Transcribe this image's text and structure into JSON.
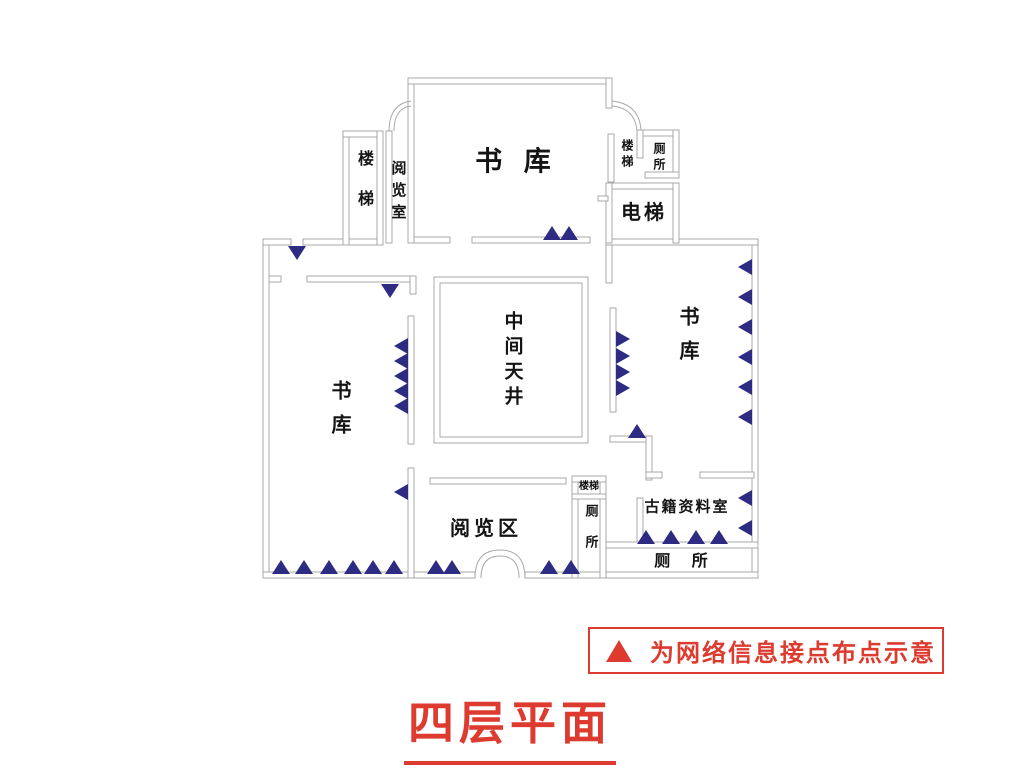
{
  "title": {
    "text": "四层平面"
  },
  "legend": {
    "symbol": "triangle-up",
    "text": "为网络信息接点布点示意"
  },
  "colors": {
    "wall": "#a9a9a9",
    "marker": "#2e2c82",
    "accent_red": "#dd3b2f",
    "label_text": "#141414"
  },
  "labels": {
    "stairs_tl": "楼梯",
    "reading_room_tl": "阅览室",
    "stacks_top": "书 库",
    "stairs_tr": "楼梯",
    "toilet_tr": "厕所",
    "elevator": "电梯",
    "atrium": "中间天井",
    "stacks_right": "书库",
    "stacks_left": "书库",
    "reading_area": "阅览区",
    "stairs_mid": "楼梯",
    "toilet_mid": "厕所",
    "archives": "古籍资料室",
    "toilet_br": "厕 所"
  },
  "markers": {
    "meaning": "网络信息接点布点",
    "color": "#2e2c82",
    "points": [
      {
        "dir": "up",
        "x": 552,
        "y": 240
      },
      {
        "dir": "up",
        "x": 569,
        "y": 240
      },
      {
        "dir": "down",
        "x": 297,
        "y": 246
      },
      {
        "dir": "down",
        "x": 390,
        "y": 284
      },
      {
        "dir": "left",
        "x": 408,
        "y": 346
      },
      {
        "dir": "left",
        "x": 408,
        "y": 361
      },
      {
        "dir": "left",
        "x": 408,
        "y": 376
      },
      {
        "dir": "left",
        "x": 408,
        "y": 391
      },
      {
        "dir": "left",
        "x": 408,
        "y": 406
      },
      {
        "dir": "left",
        "x": 408,
        "y": 492
      },
      {
        "dir": "right",
        "x": 616,
        "y": 339
      },
      {
        "dir": "right",
        "x": 616,
        "y": 356
      },
      {
        "dir": "right",
        "x": 616,
        "y": 372
      },
      {
        "dir": "right",
        "x": 616,
        "y": 388
      },
      {
        "dir": "up",
        "x": 637,
        "y": 438
      },
      {
        "dir": "left",
        "x": 752,
        "y": 267
      },
      {
        "dir": "left",
        "x": 752,
        "y": 297
      },
      {
        "dir": "left",
        "x": 752,
        "y": 327
      },
      {
        "dir": "left",
        "x": 752,
        "y": 357
      },
      {
        "dir": "left",
        "x": 752,
        "y": 387
      },
      {
        "dir": "left",
        "x": 752,
        "y": 417
      },
      {
        "dir": "left",
        "x": 752,
        "y": 498
      },
      {
        "dir": "left",
        "x": 752,
        "y": 528
      },
      {
        "dir": "up",
        "x": 646,
        "y": 544
      },
      {
        "dir": "up",
        "x": 671,
        "y": 544
      },
      {
        "dir": "up",
        "x": 696,
        "y": 544
      },
      {
        "dir": "up",
        "x": 719,
        "y": 544
      },
      {
        "dir": "up",
        "x": 281,
        "y": 574
      },
      {
        "dir": "up",
        "x": 304,
        "y": 574
      },
      {
        "dir": "up",
        "x": 329,
        "y": 574
      },
      {
        "dir": "up",
        "x": 353,
        "y": 574
      },
      {
        "dir": "up",
        "x": 373,
        "y": 574
      },
      {
        "dir": "up",
        "x": 394,
        "y": 574
      },
      {
        "dir": "up",
        "x": 436,
        "y": 574
      },
      {
        "dir": "up",
        "x": 452,
        "y": 574
      },
      {
        "dir": "up",
        "x": 549,
        "y": 574
      },
      {
        "dir": "up",
        "x": 571,
        "y": 574
      }
    ]
  }
}
